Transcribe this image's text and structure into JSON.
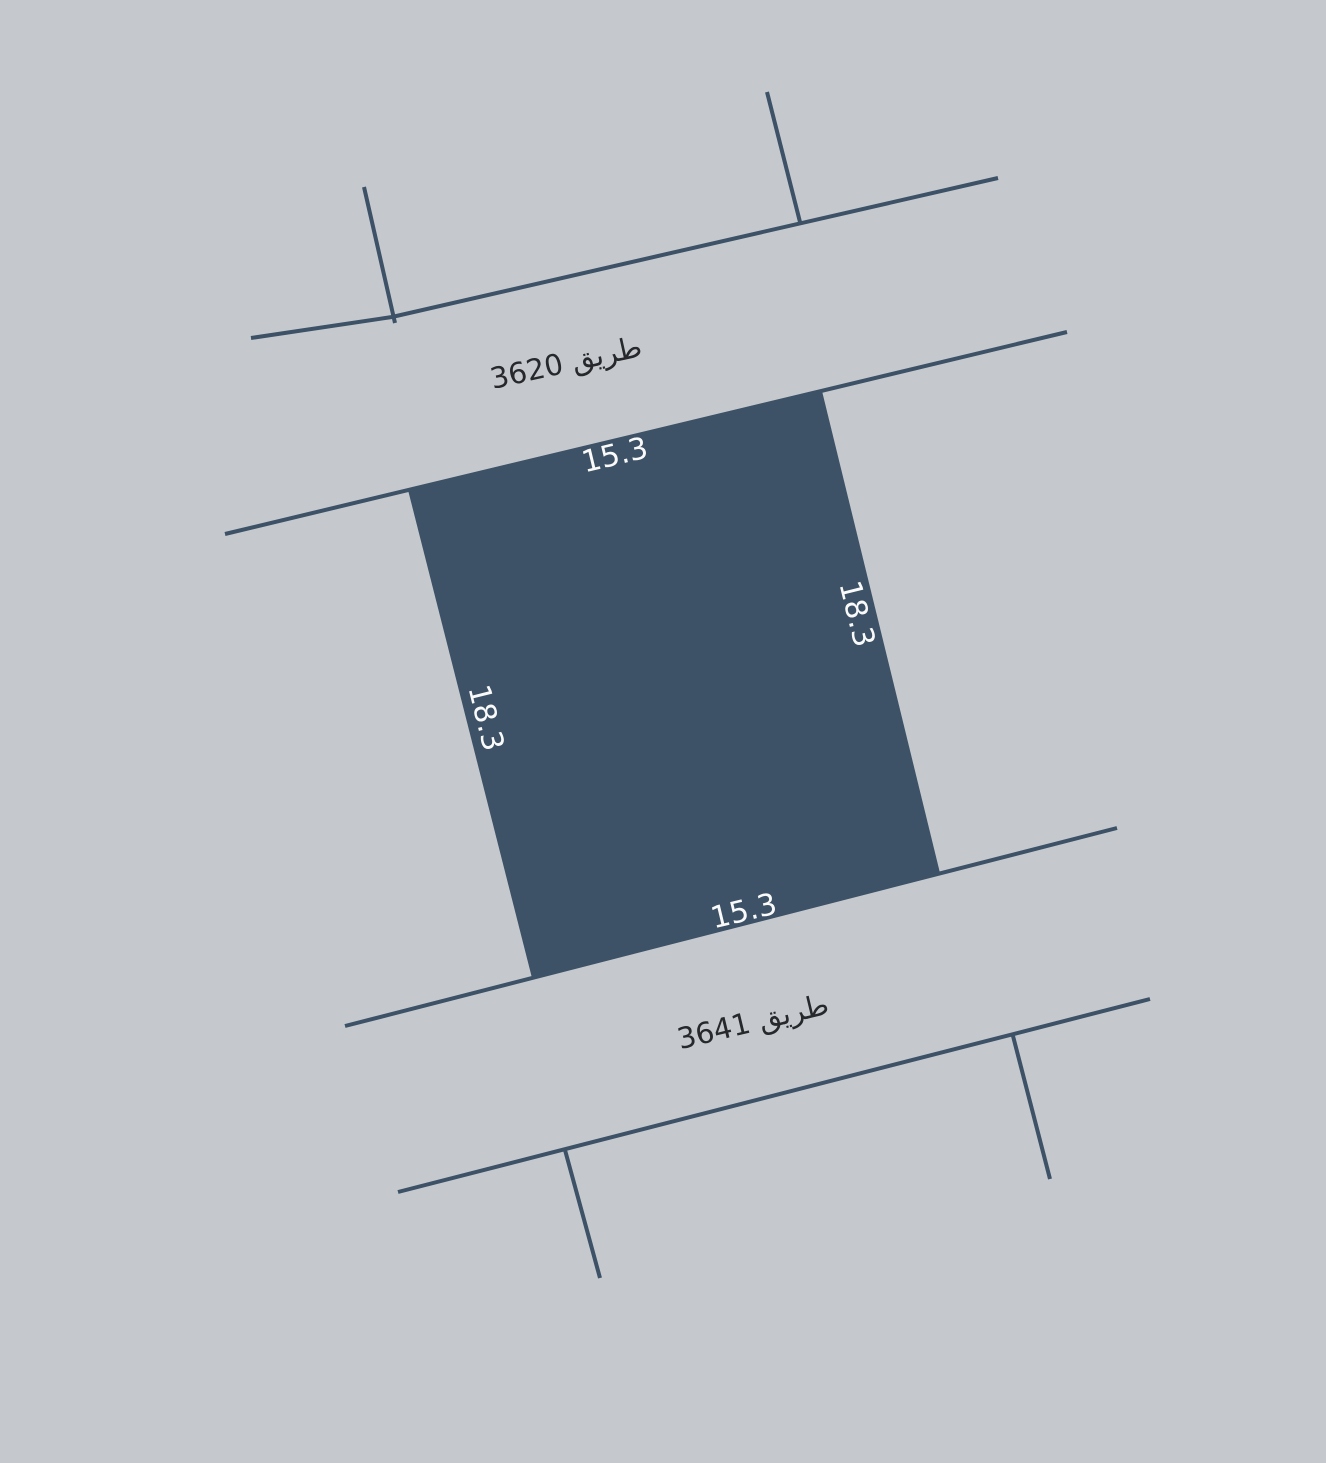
{
  "map": {
    "background_color": "#c5c9ce",
    "boundary_line_color": "#3d5266",
    "road_label_color": "#26282b",
    "roads": [
      {
        "name": "طريق 3620"
      },
      {
        "name": "طريق 3641"
      }
    ],
    "parcel": {
      "fill_color": "#3d5266",
      "dimension_label_color": "#fafafa",
      "dimensions": {
        "top": "15.3",
        "right": "18.3",
        "bottom": "15.3",
        "left": "18.3"
      }
    }
  }
}
